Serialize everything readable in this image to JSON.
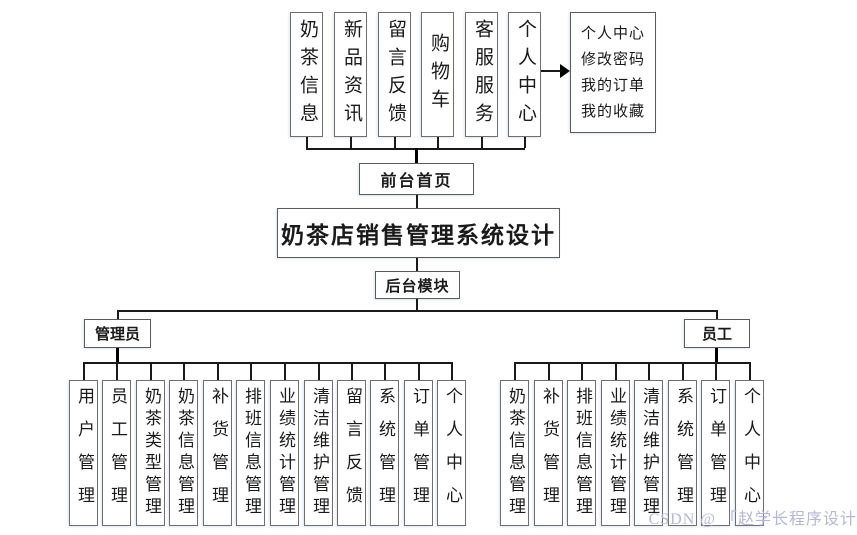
{
  "title_box": {
    "label": "奶茶店销售管理系统设计"
  },
  "frontend": {
    "home_label": "前台首页",
    "modules": [
      "奶茶信息",
      "新品资讯",
      "留言反馈",
      "购物车",
      "客服服务",
      "个人中心"
    ],
    "personal_center_detail": {
      "lines": [
        "个人中心",
        "修改密码",
        "我的订单",
        "我的收藏"
      ]
    }
  },
  "backend": {
    "label": "后台模块",
    "admin": {
      "label": "管理员",
      "modules": [
        "用户管理",
        "员工管理",
        "奶茶类型管理",
        "奶茶信息管理",
        "补货管理",
        "排班信息管理",
        "业绩统计管理",
        "清洁维护管理",
        "留言反馈",
        "系统管理",
        "订单管理",
        "个人中心"
      ]
    },
    "staff": {
      "label": "员工",
      "modules": [
        "奶茶信息管理",
        "补货管理",
        "排班信息管理",
        "业绩统计管理",
        "清洁维护管理",
        "系统管理",
        "订单管理",
        "个人中心"
      ]
    }
  },
  "watermark": {
    "text": "CSDN @ 「赵学长程序设计"
  },
  "colors": {
    "box_border": "#6e6e6e",
    "line": "#1a1a1a",
    "text": "#1a1a1a",
    "watermark": "#b6b6d6",
    "background": "#ffffff"
  }
}
